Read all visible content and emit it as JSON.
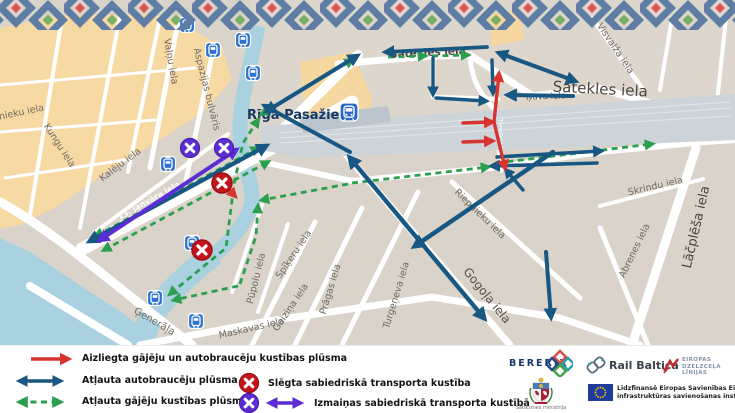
{
  "colors": {
    "restricted_red": "#d8342f",
    "traffic_blue": "#185782",
    "pedestrian_green": "#2aa04f",
    "transit_purple": "#5c2dd5",
    "transit_closed_red": "#c3161c"
  },
  "map": {
    "station": {
      "label": "Rīga Pasažieru"
    },
    "streets": {
      "grecinieku": "nieku iela",
      "kungu": "Kungu iela",
      "valnu": "Vaļņu iela",
      "aspazijas": "Aspazijas bulvāris",
      "kaleju": "Kalēju iela",
      "janvara13": "13. janvāra iela",
      "satekles_top": "Satekles iela",
      "satekles_main": "Satekles iela",
      "visvalza": "Visvalža iela",
      "nuva": "Ņuva iela",
      "timoteja": "Timoteja iela",
      "skrindu": "Skrindu iela",
      "lacplesa": "Lāčplēša iela",
      "abrenes": "Abrenes iela",
      "gogola": "Gogoļa iela",
      "riepnieku": "Riepnieku iela",
      "turgeneva": "Turgeņeva iela",
      "pragas": "Prāgas iela",
      "spikeru": "Spīķeru iela",
      "pupolu": "Pūpolu iela",
      "gaizina": "Gaiziņa iela",
      "maskavas": "Maskavas iela",
      "generala": "Ģenerāļa"
    }
  },
  "legend": {
    "flow_items": [
      {
        "label": "Aizliegta gājēju un autobraucēju kustības plūsma"
      },
      {
        "label": "Atļauta autobraucēju plūsma"
      },
      {
        "label": "Atļauta gājēju kustības plūsma"
      }
    ],
    "transit_items": [
      {
        "label": "Slēgta sabiedriskā transporta kustība"
      },
      {
        "label": "Izmaiņas sabiedriskā transporta kustībā"
      }
    ]
  },
  "logos": {
    "bererix": "BERERIX",
    "rail_baltica": "Rail Baltica",
    "edzl_lines": [
      "EIROPAS",
      "DZELZCEĻA",
      "LĪNIJAS"
    ],
    "ministry": "Satiksmes ministrija",
    "eu_lines": [
      "Līdzfinansē Eiropas Savienības Eiropas",
      "infrastruktūras savienošanas instruments"
    ]
  }
}
